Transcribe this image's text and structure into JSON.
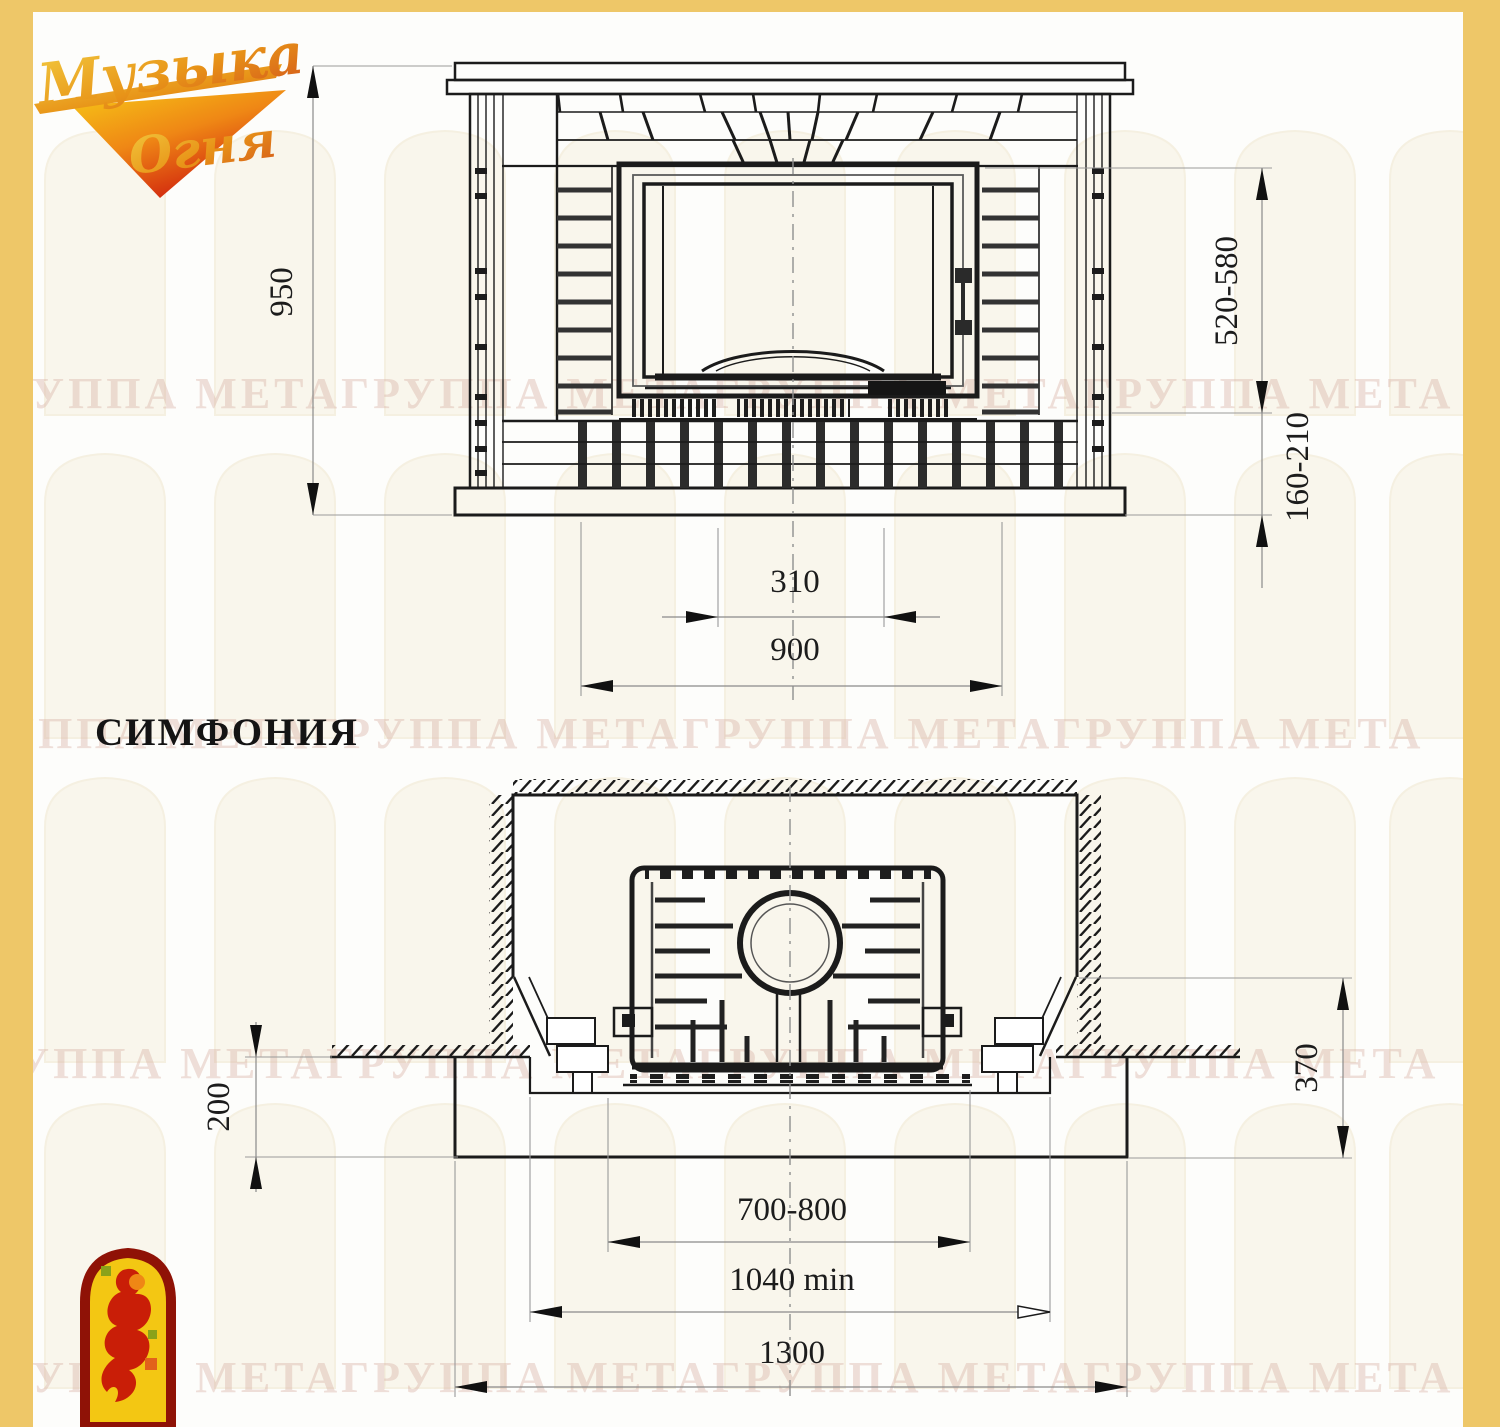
{
  "colors": {
    "border": "#eec768",
    "ink": "#1b1b1b",
    "watermark_arch": "#f6f0e0",
    "watermark_text": "#dab2a6",
    "logo_red": "#8f1206",
    "logo_yellow": "#f3c713",
    "logo_flame": "#c91e07",
    "logo_orange": "#ef8715"
  },
  "header_logo": {
    "line1": "Музыка",
    "line2": "Огня"
  },
  "model_label": "СИМФОНИЯ",
  "watermark": {
    "text": "ГРУППА МЕТАГРУППА МЕТАГРУППА МЕТАГРУППА МЕТА"
  },
  "front_view": {
    "dimensions": {
      "overall_height": "950",
      "firebox_zone_height": "520-580",
      "base_zone_height": "160-210",
      "opening_width": "310",
      "body_width": "900"
    }
  },
  "plan_view": {
    "dimensions": {
      "hearth_front_depth": "200",
      "rear_depth": "370",
      "insert_width": "700-800",
      "niche_min_width": "1040 min",
      "hearth_width": "1300"
    }
  }
}
